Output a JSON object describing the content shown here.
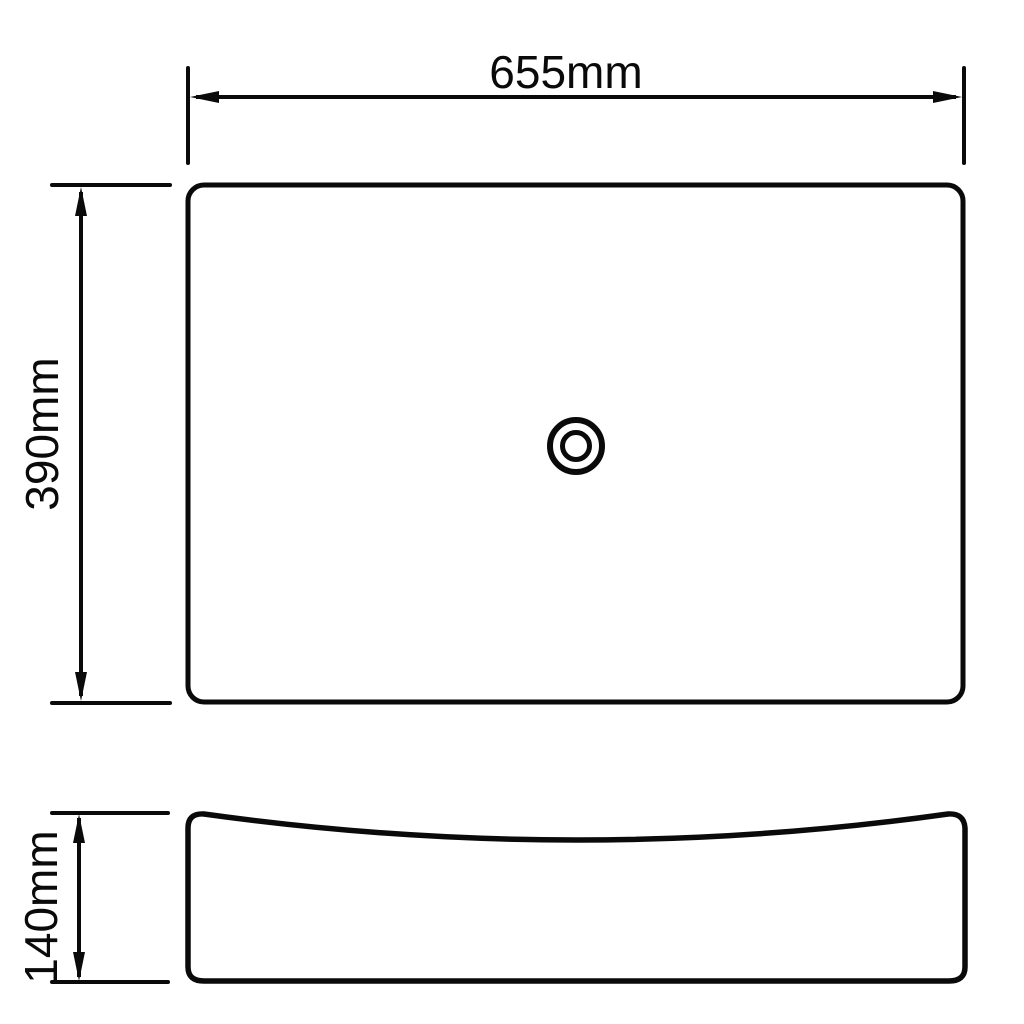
{
  "drawing": {
    "kind": "technical-dimension-drawing",
    "background_color": "#ffffff",
    "line_color": "#0a0a0a",
    "dimensions": {
      "width": {
        "label": "655mm",
        "value": 655,
        "unit": "mm"
      },
      "depth": {
        "label": "390mm",
        "value": 390,
        "unit": "mm"
      },
      "height": {
        "label": "140mm",
        "value": 140,
        "unit": "mm"
      }
    }
  }
}
